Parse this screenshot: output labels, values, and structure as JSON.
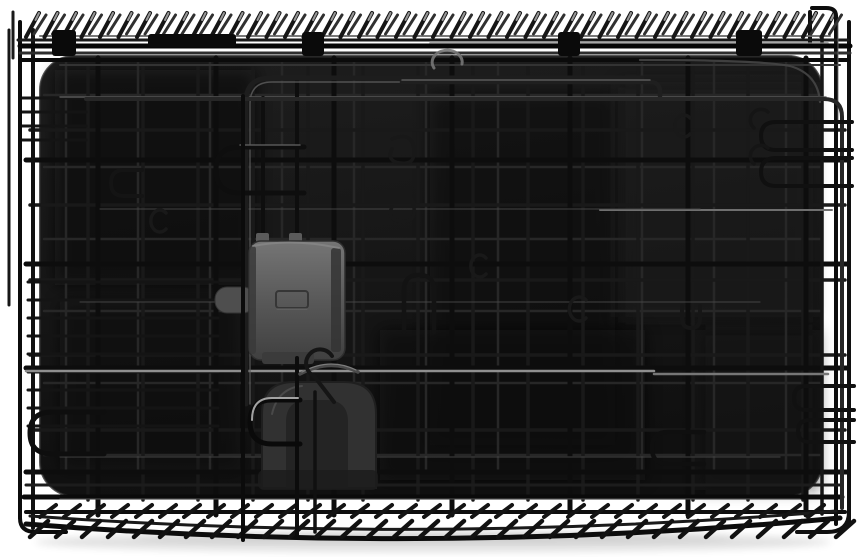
{
  "meta": {
    "description": "Studio product photograph of a black folding metal wire dog crate, collapsed flat for storage, with a black plastic floor pan and a gray plastic carry latch handle, on a plain white background. No text is visible in the image.",
    "background_color": "#ffffff"
  },
  "palette": {
    "background": "#ffffff",
    "tray_light": "#1e1e1e",
    "tray_dark": "#101010",
    "tray_sheen": "#454545",
    "wire_black": "#0c0c0c",
    "wire_dark": "#161616",
    "wire_mid": "#262626",
    "wire_highlight": "#8f8f8f",
    "latch_hi": "#757575",
    "latch_mid": "#565656",
    "latch_lo": "#404040",
    "plastic_handle": "#303030",
    "shadow": "#000000"
  },
  "scene": {
    "canvas": {
      "w": 865,
      "h": 557
    },
    "shadows": [
      {
        "cx": 433,
        "cy": 542,
        "rx": 398,
        "ry": 10,
        "opacity": 0.12
      },
      {
        "cx": 433,
        "cy": 538,
        "rx": 300,
        "ry": 5,
        "opacity": 0.08
      }
    ],
    "tray": {
      "x": 40,
      "y": 56,
      "w": 782,
      "h": 440,
      "rx": 34,
      "stroke": "#2b2b2b"
    },
    "patches": [
      [
        55,
        70,
        200,
        215,
        "#0e0e0e",
        0.75
      ],
      [
        430,
        95,
        185,
        350,
        "#101010",
        0.6
      ],
      [
        618,
        82,
        195,
        235,
        "#1e1e1e",
        0.55
      ],
      [
        380,
        330,
        265,
        150,
        "#0a0a0a",
        0.65
      ],
      [
        700,
        330,
        118,
        160,
        "#141414",
        0.6
      ],
      [
        60,
        300,
        180,
        170,
        "#0c0c0c",
        0.6
      ]
    ],
    "grids": [
      {
        "layer": "back",
        "orient": "v",
        "start": 66,
        "end": 810,
        "step": 72,
        "from": 62,
        "to": 472,
        "w": 2.5,
        "color": "#272727"
      },
      {
        "layer": "back",
        "orient": "h",
        "start": 95,
        "end": 455,
        "step": 72,
        "from": 44,
        "to": 820,
        "w": 2.5,
        "color": "#272727"
      },
      {
        "layer": "mid",
        "orient": "v",
        "start": 88,
        "end": 835,
        "step": 55,
        "from": 66,
        "to": 500,
        "w": 3.5,
        "color": "#191919"
      },
      {
        "layer": "mid",
        "orient": "h",
        "start": 130,
        "end": 430,
        "step": 75,
        "from": 30,
        "to": 845,
        "w": 3.5,
        "color": "#191919"
      },
      {
        "layer": "front",
        "orient": "v",
        "start": 98,
        "end": 806,
        "step": 118,
        "from": 58,
        "to": 515,
        "w": 5,
        "color": "#0d0d0d"
      },
      {
        "layer": "front",
        "orient": "h",
        "start": 160,
        "end": 472,
        "step": 104,
        "from": 26,
        "to": 848,
        "w": 5,
        "color": "#0d0d0d"
      },
      {
        "layer": "front",
        "orient": "h",
        "start": 282,
        "end": 426,
        "step": 18,
        "from": 28,
        "to": 218,
        "w": 3,
        "color": "#141414"
      },
      {
        "layer": "front",
        "orient": "h",
        "start": 98,
        "end": 140,
        "step": 14,
        "from": 22,
        "to": 86,
        "w": 3,
        "color": "#141414"
      }
    ],
    "lines": [
      [
        9,
        30,
        9,
        305,
        3,
        "#161616"
      ],
      [
        20,
        22,
        20,
        518,
        4,
        "#0b0b0b"
      ],
      [
        33,
        30,
        33,
        528,
        4,
        "#111111"
      ],
      [
        822,
        36,
        822,
        514,
        3.5,
        "#151515"
      ],
      [
        836,
        16,
        836,
        524,
        4,
        "#0c0c0c"
      ],
      [
        849,
        22,
        849,
        522,
        4,
        "#101010"
      ],
      [
        810,
        12,
        810,
        44,
        4,
        "#0f0f0f"
      ],
      [
        13,
        12,
        13,
        58,
        3,
        "#1a1a1a"
      ],
      [
        18,
        40,
        848,
        40,
        3,
        "#1a1a1a"
      ],
      [
        20,
        46,
        850,
        46,
        5,
        "#060606"
      ],
      [
        20,
        53,
        850,
        53,
        3,
        "#2e2e2e"
      ],
      [
        20,
        60,
        848,
        60,
        4,
        "#0b0b0b"
      ],
      [
        40,
        36,
        830,
        36,
        2,
        "#6a6a6a",
        0.9
      ],
      [
        430,
        43,
        828,
        43,
        1.5,
        "#7d7d7d",
        0.9
      ],
      [
        60,
        65,
        840,
        65,
        2,
        "#333333"
      ],
      [
        26,
        371,
        654,
        371,
        2.5,
        "#8f8f8f"
      ],
      [
        654,
        374,
        828,
        374,
        2.5,
        "#777777"
      ],
      [
        600,
        210,
        832,
        210,
        2,
        "#6f6f6f"
      ],
      [
        60,
        97,
        826,
        97,
        1.4,
        "#5e5e5e",
        0.9
      ],
      [
        100,
        209,
        700,
        209,
        1.2,
        "#4a4a4a",
        0.7
      ],
      [
        80,
        302,
        760,
        302,
        1.2,
        "#4a4a4a",
        0.7
      ],
      [
        60,
        457,
        780,
        457,
        1.2,
        "#4a4a4a",
        0.7
      ],
      [
        263,
        98,
        263,
        236,
        4,
        "#0e0e0e"
      ],
      [
        297,
        80,
        297,
        236,
        4,
        "#0e0e0e"
      ],
      [
        24,
        497,
        842,
        497,
        5,
        "#0a0a0a"
      ],
      [
        26,
        485,
        840,
        485,
        3,
        "#1c1c1c"
      ],
      [
        26,
        512,
        845,
        512,
        4,
        "#0e0e0e"
      ],
      [
        60,
        499,
        800,
        499,
        1.2,
        "#555555",
        0.8
      ],
      [
        838,
        20,
        838,
        120,
        1.2,
        "#6f6f6f",
        0.7
      ]
    ],
    "comb": {
      "x0": 26,
      "step": 18.5,
      "count": 44,
      "rows": [
        {
          "dx0": 8,
          "y0": 34,
          "dx1": 20,
          "y1": 15,
          "w": 3,
          "color": "#303030",
          "cap": false
        },
        {
          "dx0": 0,
          "y0": 37,
          "dx1": 13,
          "y1": 13,
          "w": 4,
          "color": "#161616",
          "cap": true
        }
      ],
      "cap_color": "#9e9e9e"
    },
    "clips": {
      "color": "#0a0a0a",
      "rects": [
        [
          52,
          30,
          24,
          26
        ],
        [
          302,
          32,
          22,
          24
        ],
        [
          558,
          32,
          22,
          24
        ],
        [
          736,
          30,
          26,
          26
        ],
        [
          148,
          34,
          88,
          13
        ]
      ]
    },
    "hatch": [
      {
        "x0": 40,
        "x1": 826,
        "step": 24,
        "y_low": 517,
        "y_high": 505,
        "dx": 16,
        "w": 4,
        "color": "#141414"
      },
      {
        "x0": 30,
        "x1": 836,
        "step": 26,
        "y_low": 537,
        "y_high": 521,
        "dx": 18,
        "w": 4.5,
        "color": "#111111"
      }
    ],
    "paths": [
      {
        "name": "tray-corner-sheen",
        "d": "M 640 60 Q 760 60 790 66 Q 818 74 820 102",
        "w": 2.2,
        "color": "#454545",
        "opacity": 0.9
      },
      {
        "name": "door-frame",
        "d": "M 246 404 V 102 Q 246 78 270 78 H 642",
        "w": 5,
        "color": "#1d1d1d"
      },
      {
        "name": "door-frame-highlight",
        "d": "M 250 404 V 104 Q 250 82 272 82 H 640",
        "w": 1.4,
        "color": "#5a5a5a",
        "opacity": 0.85
      },
      {
        "name": "door-rail",
        "d": "M 402 82 H 650 Q 660 82 660 92 V 96",
        "w": 4.5,
        "color": "#1f1f1f"
      },
      {
        "name": "door-rail-highlight",
        "d": "M 402 80 H 650",
        "w": 1.5,
        "color": "#606060",
        "opacity": 0.9
      },
      {
        "name": "side-rail-corner",
        "d": "M 86 99 H 824 Q 842 99 842 117 V 508",
        "w": 4,
        "color": "#262626"
      },
      {
        "name": "door-handle-loop",
        "d": "M 304 147 H 240 Q 216 147 216 170 Q 216 193 240 193 H 304",
        "w": 5,
        "color": "#0e0e0e"
      },
      {
        "name": "door-handle-loop-highlight",
        "d": "M 300 145 H 240",
        "w": 1.5,
        "color": "#6a6a6a",
        "opacity": 0.8
      },
      {
        "name": "hook-bottom-left",
        "d": "M 104 412 H 52 Q 30 412 30 433 Q 30 454 52 454 H 104",
        "w": 5,
        "color": "#0e0e0e"
      },
      {
        "name": "hook-left-small",
        "d": "M 142 170 H 124 Q 111 170 111 183 Q 111 196 124 196 H 142",
        "w": 4,
        "color": "#141414"
      },
      {
        "name": "hook-right-1",
        "d": "M 852 122 H 776 Q 761 122 761 136 Q 761 150 776 150 H 852",
        "w": 4,
        "color": "#101010"
      },
      {
        "name": "hook-right-2",
        "d": "M 852 158 H 776 Q 761 158 761 172 Q 761 186 776 186 H 852",
        "w": 4,
        "color": "#101010"
      },
      {
        "name": "hook-right-curl-1",
        "d": "M 768 112 A 10 10 0 1 0 754 128",
        "w": 3.5,
        "color": "#151515"
      },
      {
        "name": "hook-right-curl-2",
        "d": "M 768 148 A 10 10 0 1 0 754 164",
        "w": 3.5,
        "color": "#151515"
      },
      {
        "name": "hook-right-bottom-1",
        "d": "M 854 386 H 806 Q 794 386 794 398 Q 794 410 806 410 H 854",
        "w": 4,
        "color": "#111111"
      },
      {
        "name": "hook-right-bottom-2",
        "d": "M 854 420 H 810 Q 798 420 798 431 Q 798 442 810 442 H 854",
        "w": 4,
        "color": "#111111"
      },
      {
        "name": "hook-mid-bottom",
        "d": "M 704 432 H 668 Q 652 432 652 448 Q 652 464 668 464 H 704",
        "w": 4.5,
        "color": "#0f0f0f"
      },
      {
        "name": "wire-curl-1",
        "d": "M 392 139 Q 412 131 414 149 Q 416 165 400 163 Q 386 161 392 149",
        "w": 3.5,
        "color": "#181818"
      },
      {
        "name": "wire-curl-2",
        "d": "M 392 197 Q 412 189 414 207 Q 416 223 400 221 Q 386 219 392 207",
        "w": 3.5,
        "color": "#181818"
      },
      {
        "name": "vertical-u-loop",
        "d": "M 404 332 V 290 Q 404 275 419 275 Q 434 275 434 290 V 332",
        "w": 4.5,
        "color": "#131313"
      },
      {
        "name": "vertical-u-small",
        "d": "M 682 306 V 318 Q 682 328 691 328 Q 700 328 700 318 V 306",
        "w": 4,
        "color": "#161616"
      },
      {
        "name": "latch-ring",
        "d": "M 434 68 A 15 12 0 1 1 462 64",
        "w": 3,
        "color": "#777777",
        "opacity": 0.9
      },
      {
        "name": "c-hook-1",
        "d": "M 586 300 A 10 12 0 1 0 586 318",
        "w": 3.5,
        "color": "#191919"
      },
      {
        "name": "c-hook-2",
        "d": "M 486 258 A 9 11 0 1 0 486 274",
        "w": 3.5,
        "color": "#191919"
      },
      {
        "name": "c-hook-3",
        "d": "M 166 213 A 9 11 0 1 0 166 229",
        "w": 3.5,
        "color": "#191919"
      },
      {
        "name": "c-hook-4",
        "d": "M 690 118 A 9 11 0 1 0 690 134",
        "w": 3.5,
        "color": "#191919"
      },
      {
        "name": "corner-bottom-left",
        "d": "M 20 518 Q 20 532 36 532 H 66",
        "w": 4,
        "color": "#0b0b0b"
      },
      {
        "name": "corner-bottom-right",
        "d": "M 849 512 Q 849 532 827 532 H 797",
        "w": 4,
        "color": "#101010"
      },
      {
        "name": "corner-top-right",
        "d": "M 836 16 Q 836 8 826 8 H 812",
        "w": 4,
        "color": "#0c0c0c"
      },
      {
        "name": "bottom-edge-outer",
        "d": "M 26 524 Q 430 556 840 518",
        "w": 5,
        "color": "#0c0c0c"
      },
      {
        "name": "bottom-edge-inner",
        "d": "M 30 516 Q 430 545 836 511",
        "w": 3,
        "color": "#1a1a1a"
      }
    ],
    "latch": {
      "body": {
        "x": 249,
        "y": 241,
        "w": 96,
        "h": 119,
        "rx": 12,
        "stroke": "#2e2e2e"
      },
      "tab": {
        "x": 215,
        "y": 287,
        "w": 40,
        "h": 26,
        "rx": 12,
        "fill": "#4e4e4e",
        "stroke": "#333333"
      },
      "nubs": [
        [
          256,
          233,
          13,
          10
        ],
        [
          289,
          233,
          13,
          10
        ]
      ],
      "nub_fill": "#5b5b5b",
      "strips": [
        [
          249,
          246,
          7,
          108,
          "#3a3a3a"
        ],
        [
          331,
          248,
          10,
          104,
          "#343434"
        ]
      ],
      "emboss": {
        "x": 276,
        "y": 291,
        "w": 32,
        "h": 17,
        "rx": 3,
        "stroke": "#363636"
      },
      "emboss_highlight": [
        277,
        309,
        307,
        309,
        1,
        "#6d6d6d"
      ],
      "lip": {
        "x": 262,
        "y": 352,
        "w": 52,
        "h": 12,
        "rx": 3,
        "fill": "#3b3b3b"
      },
      "sheen_d": "M 253 246 Q 293 238 339 248",
      "sheen_color": "#8a8a8a"
    },
    "handle": {
      "outer_d": "M 262 488 V 414 Q 262 382 294 382 H 344 Q 376 382 376 414 V 488 Z",
      "outer_fill": "#313131",
      "inner_d": "M 286 488 V 422 Q 286 400 308 400 H 326 Q 348 400 348 422 V 488 Z",
      "inner_fill": "#242424",
      "base": {
        "x": 258,
        "y": 470,
        "w": 120,
        "h": 20,
        "rx": 6,
        "fill": "#1c1c1c"
      },
      "sheen_d": "M 272 414 Q 278 388 302 386",
      "sheen_color": "#505050"
    },
    "overlay_lines": [
      [
        243,
        96,
        243,
        540,
        4,
        "#0b0b0b"
      ],
      [
        297,
        358,
        297,
        536,
        4,
        "#0c0c0c"
      ],
      [
        315,
        392,
        315,
        532,
        3.5,
        "#101010"
      ]
    ],
    "overlay_paths": [
      {
        "name": "handle-wire-u",
        "d": "M 300 400 H 272 Q 250 400 250 422 Q 250 444 272 444 H 300",
        "w": 5,
        "color": "#0a0a0a"
      },
      {
        "name": "handle-wire-u-highlight",
        "d": "M 298 398 H 272 Q 252 398 252 420",
        "w": 2,
        "color": "#ababab",
        "opacity": 0.95
      },
      {
        "name": "handle-arch-wire",
        "d": "M 300 374 Q 330 358 358 372",
        "w": 3.5,
        "color": "#4a4a4a"
      },
      {
        "name": "handle-arch-highlight",
        "d": "M 302 372 Q 330 357 356 370",
        "w": 1.2,
        "color": "#8a8a8a",
        "opacity": 0.8
      },
      {
        "name": "handle-curl-wire",
        "d": "M 332 356 A 14 14 0 1 0 314 376 L 334 402",
        "w": 4,
        "color": "#151515"
      }
    ]
  }
}
